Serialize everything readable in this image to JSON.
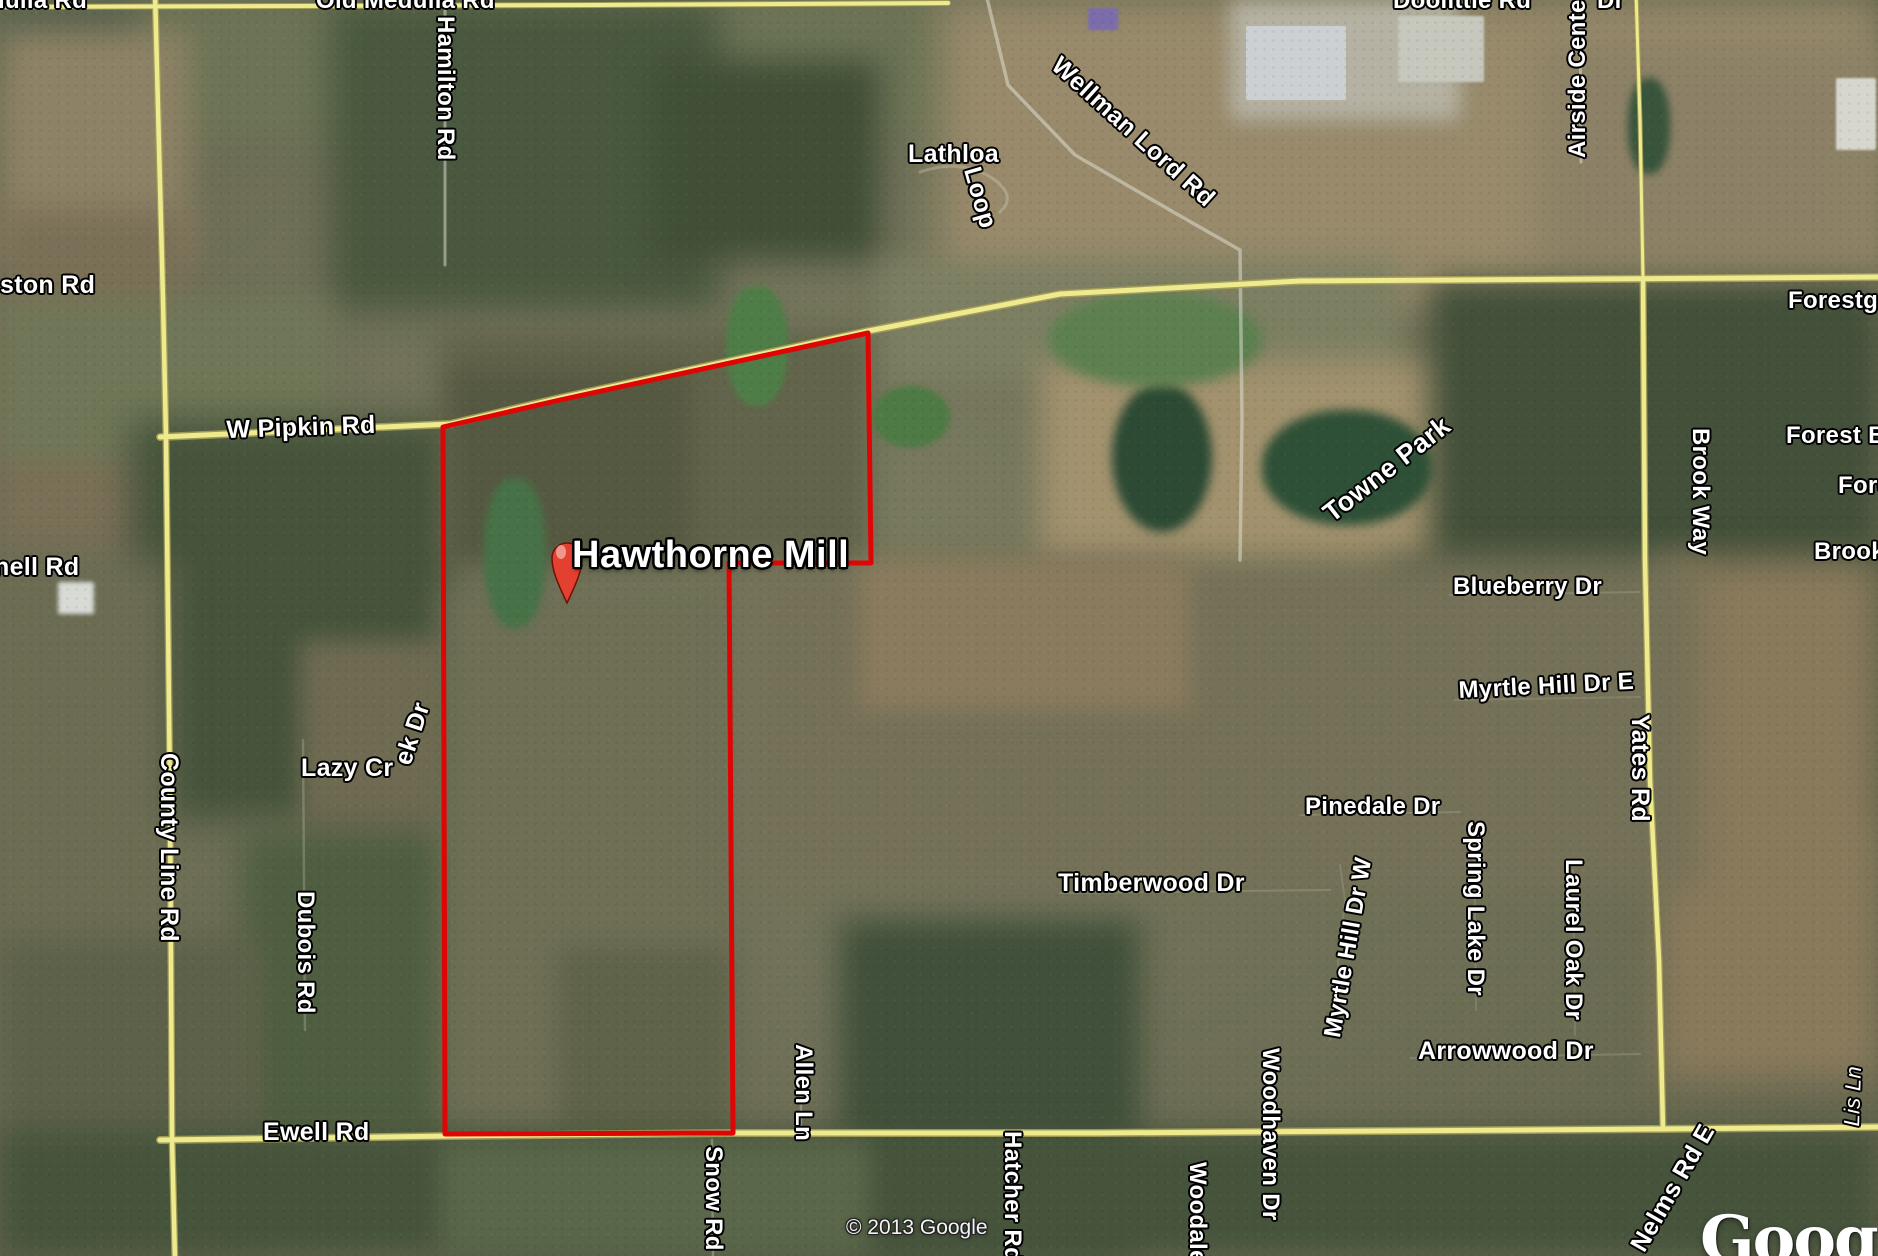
{
  "map": {
    "attribution": "© 2013 Google",
    "watermark": "Google",
    "placemark": {
      "label": "Hawthorne Mill"
    },
    "colors": {
      "boundary_red": "#e00505",
      "road_yellow": "#eeea8e",
      "road_casing": "#a79f58",
      "label_white": "#ffffff",
      "pin_red": "#e3402f"
    },
    "labels": [
      {
        "name": "road-label-medulla-fragment",
        "text": "dulla Rd",
        "x": -10,
        "y": -12,
        "rot": 0,
        "size": 24
      },
      {
        "name": "road-label-old-medulla-rd",
        "text": "Old Medulla Rd",
        "x": 316,
        "y": -12,
        "rot": 0,
        "size": 24
      },
      {
        "name": "road-label-hamilton-rd",
        "text": "Hamilton Rd",
        "x": 458,
        "y": 16,
        "rot": 90,
        "size": 24
      },
      {
        "name": "road-label-doolittle-rd",
        "text": "Doolittle Rd",
        "x": 1393,
        "y": -12,
        "rot": 0,
        "size": 24
      },
      {
        "name": "road-label-dr-fragment",
        "text": "Dr",
        "x": 1597,
        "y": -12,
        "rot": 0,
        "size": 24
      },
      {
        "name": "road-label-airside-center-dr",
        "text": "Airside Cente",
        "x": 1565,
        "y": 158,
        "rot": -90,
        "size": 24
      },
      {
        "name": "road-label-wellman-lord-rd",
        "text": "Wellman Lord Rd",
        "x": 1064,
        "y": 52,
        "rot": 42,
        "size": 25
      },
      {
        "name": "road-label-lathloa",
        "text": "Lathloa",
        "x": 908,
        "y": 141,
        "rot": 0,
        "size": 25
      },
      {
        "name": "road-label-loop",
        "text": "Loop",
        "x": 984,
        "y": 164,
        "rot": 74,
        "size": 25
      },
      {
        "name": "road-label-ston-rd",
        "text": "ston Rd",
        "x": 0,
        "y": 272,
        "rot": 0,
        "size": 25
      },
      {
        "name": "road-label-forestg",
        "text": "Forestg",
        "x": 1788,
        "y": 288,
        "rot": 0,
        "size": 24
      },
      {
        "name": "road-label-w-pipkin-rd",
        "text": "W Pipkin Rd",
        "x": 226,
        "y": 417,
        "rot": -2,
        "size": 25
      },
      {
        "name": "road-label-forest-b",
        "text": "Forest B",
        "x": 1786,
        "y": 423,
        "rot": 0,
        "size": 24
      },
      {
        "name": "place-label-towne-park",
        "text": "Towne Park",
        "x": 1318,
        "y": 505,
        "rot": -38,
        "size": 27
      },
      {
        "name": "road-label-brook-way",
        "text": "Brook Way",
        "x": 1713,
        "y": 428,
        "rot": 90,
        "size": 24
      },
      {
        "name": "road-label-fore-fragment",
        "text": "Fore",
        "x": 1838,
        "y": 473,
        "rot": 0,
        "size": 24
      },
      {
        "name": "road-label-brook-fragment",
        "text": "Brook",
        "x": 1814,
        "y": 539,
        "rot": 0,
        "size": 24
      },
      {
        "name": "road-label-nell-rd",
        "text": "nell Rd",
        "x": -6,
        "y": 554,
        "rot": 0,
        "size": 25
      },
      {
        "name": "road-label-blueberry-dr",
        "text": "Blueberry Dr",
        "x": 1453,
        "y": 574,
        "rot": 0,
        "size": 24
      },
      {
        "name": "road-label-myrtle-hill-dr-e",
        "text": "Myrtle Hill Dr E",
        "x": 1458,
        "y": 678,
        "rot": -3,
        "size": 24
      },
      {
        "name": "road-label-yates-rd",
        "text": "Yates Rd",
        "x": 1653,
        "y": 714,
        "rot": 90,
        "size": 25
      },
      {
        "name": "road-label-lazy-cr",
        "text": "Lazy Cr",
        "x": 301,
        "y": 755,
        "rot": 0,
        "size": 25
      },
      {
        "name": "road-label-ek-dr",
        "text": "ek Dr",
        "x": 390,
        "y": 760,
        "rot": -72,
        "size": 25
      },
      {
        "name": "road-label-county-line-rd",
        "text": "County Line Rd",
        "x": 182,
        "y": 753,
        "rot": 90,
        "size": 25
      },
      {
        "name": "road-label-pinedale-dr",
        "text": "Pinedale Dr",
        "x": 1305,
        "y": 794,
        "rot": 0,
        "size": 24
      },
      {
        "name": "road-label-spring-lake-dr",
        "text": "Spring Lake Dr",
        "x": 1488,
        "y": 821,
        "rot": 90,
        "size": 24
      },
      {
        "name": "road-label-laurel-oak-dr",
        "text": "Laurel Oak Dr",
        "x": 1586,
        "y": 859,
        "rot": 90,
        "size": 24
      },
      {
        "name": "road-label-timberwood-dr",
        "text": "Timberwood Dr",
        "x": 1058,
        "y": 870,
        "rot": 0,
        "size": 25
      },
      {
        "name": "road-label-dubois-rd",
        "text": "Dubois Rd",
        "x": 318,
        "y": 891,
        "rot": 90,
        "size": 24
      },
      {
        "name": "road-label-myrtle-hill-dr-w",
        "text": "Myrtle Hill Dr W",
        "x": 1320,
        "y": 1035,
        "rot": -80,
        "size": 24
      },
      {
        "name": "road-label-arrowwood-dr",
        "text": "Arrowwood Dr",
        "x": 1418,
        "y": 1038,
        "rot": 0,
        "size": 25
      },
      {
        "name": "road-label-allen-ln",
        "text": "Allen Ln",
        "x": 816,
        "y": 1044,
        "rot": 90,
        "size": 24
      },
      {
        "name": "road-label-ewell-rd",
        "text": "Ewell Rd",
        "x": 263,
        "y": 1119,
        "rot": 0,
        "size": 25
      },
      {
        "name": "road-label-snow-rd",
        "text": "Snow Rd",
        "x": 726,
        "y": 1146,
        "rot": 90,
        "size": 24
      },
      {
        "name": "road-label-hatcher-rd",
        "text": "Hatcher Rd",
        "x": 1025,
        "y": 1131,
        "rot": 90,
        "size": 24
      },
      {
        "name": "road-label-woodale-dr",
        "text": "Woodale Dr",
        "x": 1210,
        "y": 1162,
        "rot": 90,
        "size": 24
      },
      {
        "name": "road-label-woodhaven-dr",
        "text": "Woodhaven Dr",
        "x": 1283,
        "y": 1048,
        "rot": 90,
        "size": 24
      },
      {
        "name": "road-label-nelms-rd-e",
        "text": "Nelms Rd E",
        "x": 1626,
        "y": 1243,
        "rot": -60,
        "size": 25
      },
      {
        "name": "road-label-lis-ln",
        "text": "Lis Ln",
        "x": 1840,
        "y": 1126,
        "rot": -88,
        "size": 22,
        "style": "italic"
      }
    ]
  }
}
